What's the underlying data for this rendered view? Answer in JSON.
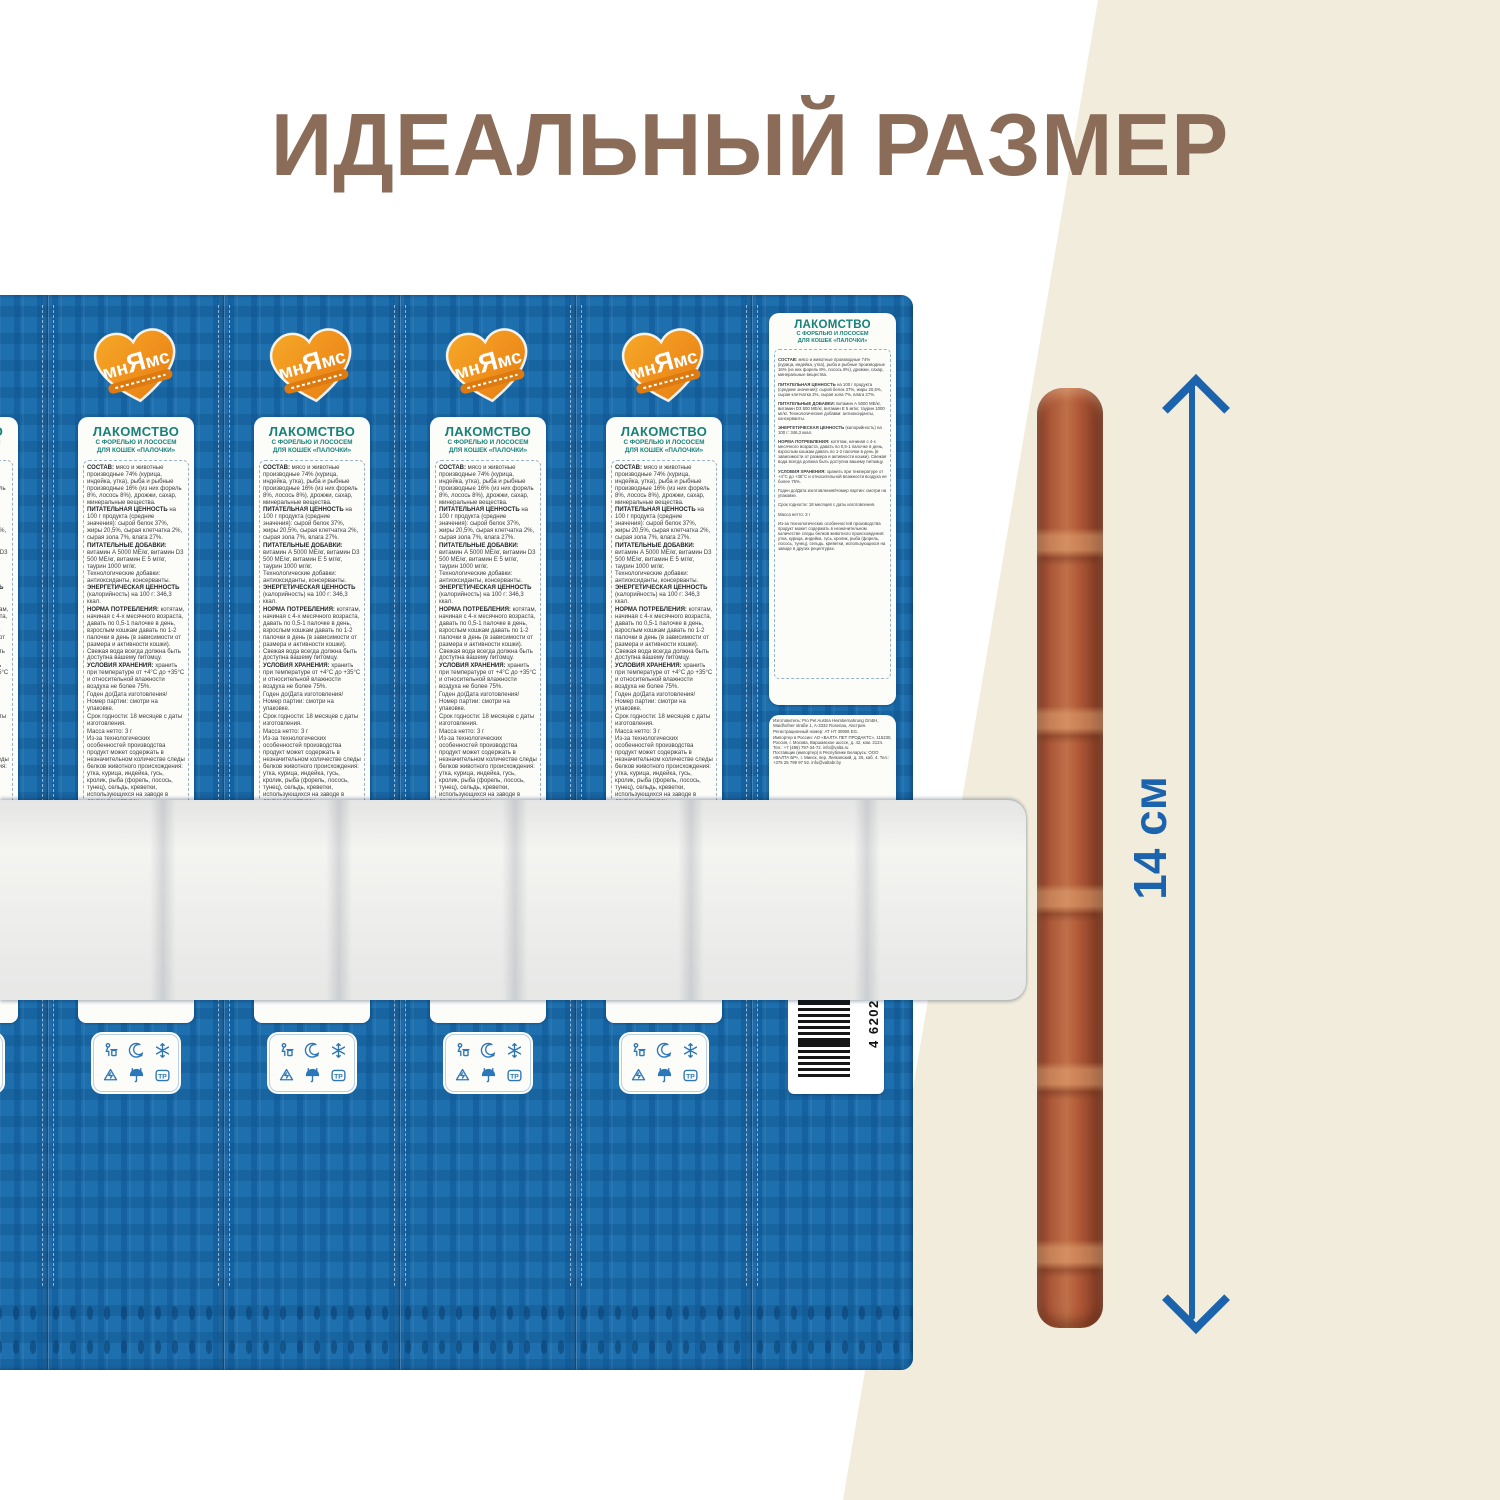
{
  "page": {
    "title": "ИДЕАЛЬНЫЙ РАЗМЕР"
  },
  "colors": {
    "title_brown": "#8a6c58",
    "package_blue": "#1e6fae",
    "label_teal": "#17817a",
    "accent_orange": "#ef941f",
    "measure_blue": "#1c63ae",
    "beige_background": "#f2ecdd",
    "stick_brown": "#a85436"
  },
  "logo": {
    "part1": "мн",
    "part2": "Я",
    "part3": "мс"
  },
  "label": {
    "header": "ЛАКОМСТВО",
    "subheader1": "С ФОРЕЛЬЮ И ЛОСОСЕМ",
    "subheader2": "ДЛЯ КОШЕК «ПАЛОЧКИ»",
    "sections": [
      {
        "h": "СОСТАВ:",
        "t": "мясо и животные производные 74% (курица, индейка, утка), рыба и рыбные производные 16% (из них форель 8%, лосось 8%), дрожжи, сахар, минеральные вещества."
      },
      {
        "h": "ПИТАТЕЛЬНАЯ ЦЕННОСТЬ",
        "t": "на 100 г продукта (средние значения): сырой белок 37%, жиры 20,5%, сырая клетчатка 2%, сырая зола 7%, влага 27%."
      },
      {
        "h": "ПИТАТЕЛЬНЫЕ ДОБАВКИ:",
        "t": "витамин А 5000 МЕ/кг, витамин D3 500 МЕ/кг, витамин Е 5 мг/кг, таурин 1000 мг/кг. Технологические добавки: антиоксиданты, консерванты."
      },
      {
        "h": "ЭНЕРГЕТИЧЕСКАЯ ЦЕННОСТЬ",
        "t": "(калорийность) на 100 г: 346,3 ккал."
      },
      {
        "h": "НОРМА ПОТРЕБЛЕНИЯ:",
        "t": "котятам, начиная с 4-х месячного возраста, давать по 0,5-1 палочке в день, взрослым кошкам давать по 1-2 палочки в день (в зависимости от размера и активности кошки). Свежая вода всегда должна быть доступна вашему питомцу."
      },
      {
        "h": "УСЛОВИЯ ХРАНЕНИЯ:",
        "t": "хранить при температуре от +4°С до +35°С и относительной влажности воздуха не более 75%."
      },
      {
        "h": "",
        "t": "Годен до/Дата изготовления/Номер партии: смотри на упаковке."
      },
      {
        "h": "",
        "t": "Срок годности: 18 месяцев с даты изготовления."
      },
      {
        "h": "",
        "t": "Масса нетто: 3 г"
      },
      {
        "h": "",
        "t": "Из-за технологических особенностей производства продукт может содержать в незначительном количестве следы белков животного происхождения: утка, курица, индейка, гусь, кролик, рыба (форель, лосось, тунец), сельдь, креветки, использующихся на заводе в других рецептурах."
      }
    ]
  },
  "manufacturer": {
    "lines": [
      "Изготовитель: Pro Pet Austria Heimtiernahrung GmbH, Waidhofner straße 1, A-3332 Rosenau, Австрия.",
      "Регистрационный номер: AT HT 30906 EG.",
      "Импортер в России: АО «ВАЛТА ПЕТ ПРОДАКТС», 115230, Россия, г. Москва, Варшавское шоссе, д. 42, ком. 2124. Тел.: +7 (495) 797-34-72. info@valta.ru",
      "Поставщик (импортер) в Республике Беларусь: ООО «ВАЛТА БР», г. Минск, пер. Липковский, д. 26, каб. 4. Тел.: +375 25 799 97 92. info@valtabr.by"
    ]
  },
  "package_icons": {
    "names": [
      "tidy-man-icon",
      "crescent-moon-icon",
      "snowflake-icon",
      "recycle-triangle-icon",
      "keep-dry-umbrella-icon",
      "tr-mark-icon"
    ],
    "tr_label": "ТР"
  },
  "barcode": {
    "number": "4 620202 548627"
  },
  "measurement": {
    "label": "14 см"
  }
}
